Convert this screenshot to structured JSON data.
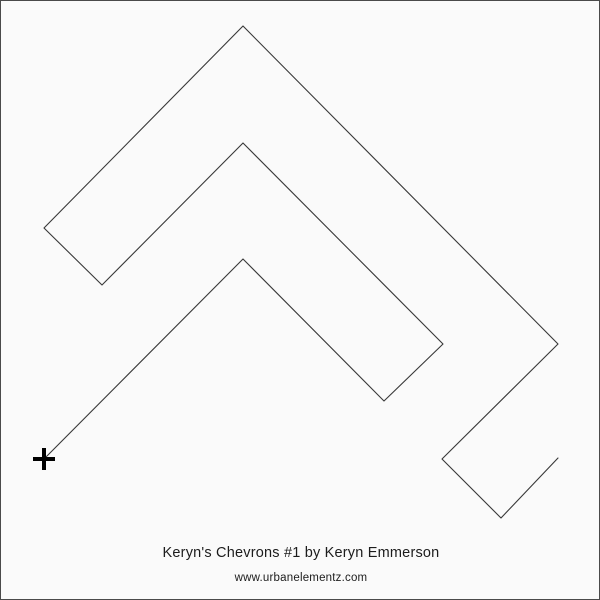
{
  "page": {
    "background_color": "#fafafa",
    "border_color": "#4a4a4a",
    "text_color": "#1c1c1c"
  },
  "pattern": {
    "description": "continuous chevron quilting pantograph polyline",
    "line_color": "#383838",
    "line_width": 1.1,
    "path_points": [
      [
        43,
        458
      ],
      [
        242,
        258
      ],
      [
        383,
        400
      ],
      [
        442,
        343
      ],
      [
        242,
        142
      ],
      [
        101,
        284
      ],
      [
        43,
        227
      ],
      [
        242,
        25
      ],
      [
        557,
        343
      ],
      [
        441,
        458
      ],
      [
        500,
        517
      ],
      [
        557,
        457
      ]
    ],
    "start_marker": {
      "x": 43,
      "y": 458,
      "arm_length": 11,
      "thickness": 4,
      "color": "#000000"
    }
  },
  "footer": {
    "title": "Keryn's Chevrons #1 by Keryn Emmerson",
    "website": "www.urbanelementz.com"
  }
}
